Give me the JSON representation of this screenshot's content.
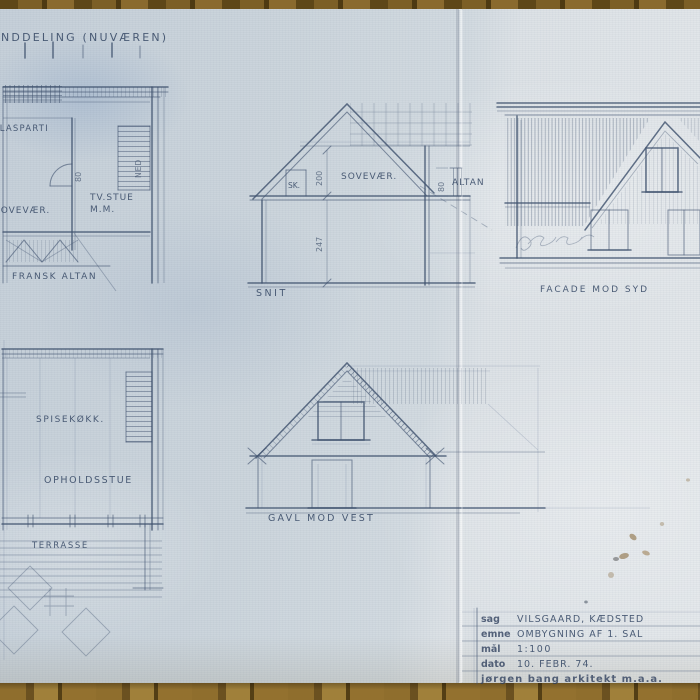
{
  "photo": {
    "colors": {
      "paper_blue": "#ccd5dc",
      "paper_white": "#e3e7ea",
      "pencil": "#41536f",
      "wood": "#8a6a2e"
    },
    "header": {
      "title": "NDDELING (NUVÆREN)"
    },
    "plan_upper": {
      "glasparti": "GLASPARTI",
      "tv_stue_line1": "TV.STUE",
      "tv_stue_line2": "M.M.",
      "sovevaer": "SOVEVÆR.",
      "ned": "NED",
      "door_width": "80",
      "fransk_altan": "FRANSK ALTAN"
    },
    "section": {
      "label": "SNIT",
      "closet": "SK.",
      "room": "SOVEVÆR.",
      "dim_upper": "200",
      "dim_lower": "247",
      "altan": "ALTAN",
      "altan_width": "80"
    },
    "facade": {
      "label": "FACADE MOD SYD"
    },
    "plan_lower": {
      "kitchen": "SPISEKØKK.",
      "living": "OPHOLDSSTUE",
      "terrace": "TERRASSE"
    },
    "gable": {
      "label": "GAVL MOD VEST"
    },
    "title_block": {
      "rows": [
        {
          "key": "sag",
          "value": "VILSGAARD, KÆDSTED"
        },
        {
          "key": "emne",
          "value": "OMBYGNING AF 1. SAL"
        },
        {
          "key": "mål",
          "value": "1:100"
        },
        {
          "key": "dato",
          "value": "10. FEBR. 74."
        }
      ],
      "stamp": "jørgen bang  arkitekt m.a.a."
    }
  }
}
